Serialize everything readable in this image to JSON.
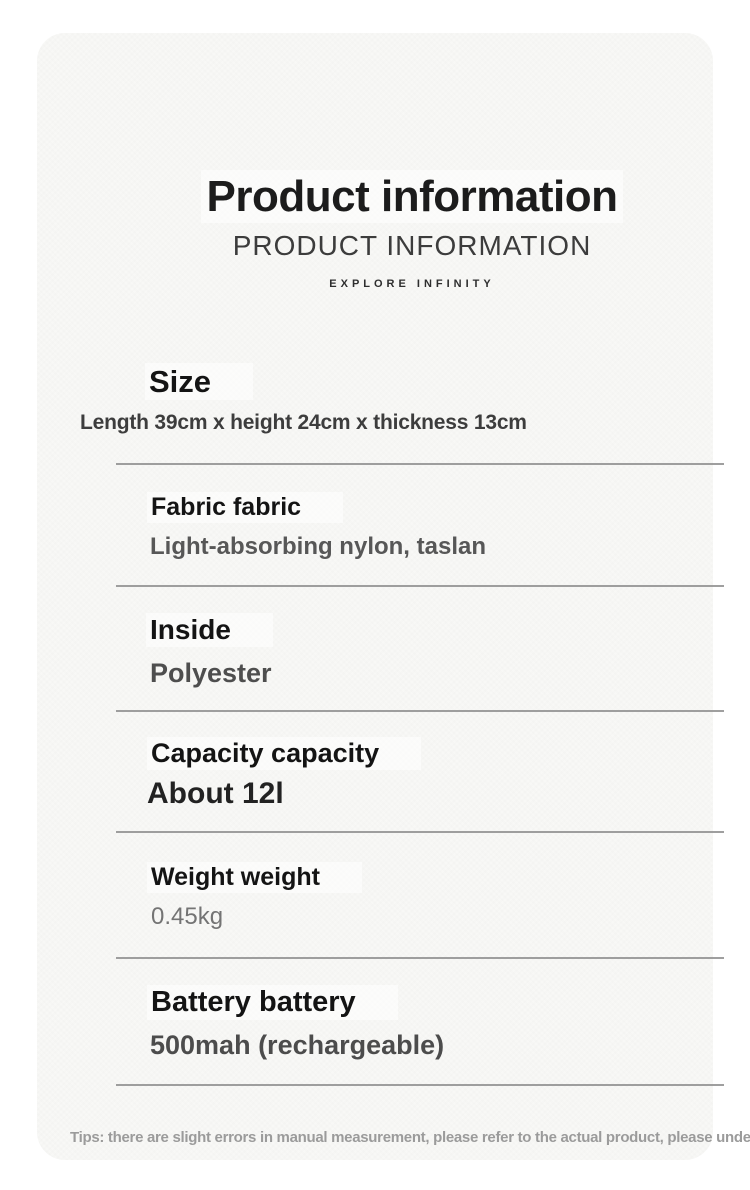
{
  "page": {
    "title": "Product information",
    "subtitle": "PRODUCT INFORMATION",
    "tagline": "EXPLORE INFINITY",
    "tip": "Tips: there are slight errors in manual measurement, please refer to the actual product, please understand."
  },
  "sections": [
    {
      "heading": "Size",
      "value": "Length 39cm x height 24cm x thickness 13cm"
    },
    {
      "heading": "Fabric fabric",
      "value": "Light-absorbing nylon, taslan"
    },
    {
      "heading": "Inside",
      "value": "Polyester"
    },
    {
      "heading": "Capacity capacity",
      "value": "About 12l"
    },
    {
      "heading": "Weight weight",
      "value": "0.45kg"
    },
    {
      "heading": "Battery battery",
      "value": "500mah (rechargeable)"
    }
  ],
  "colors": {
    "page_background": "#ffffff",
    "card_background": "#f8f8f6",
    "heading_text": "#141414",
    "value_text_gray": "#575757",
    "divider": "#8e8e8e",
    "tip_text": "#9b9b9b"
  }
}
